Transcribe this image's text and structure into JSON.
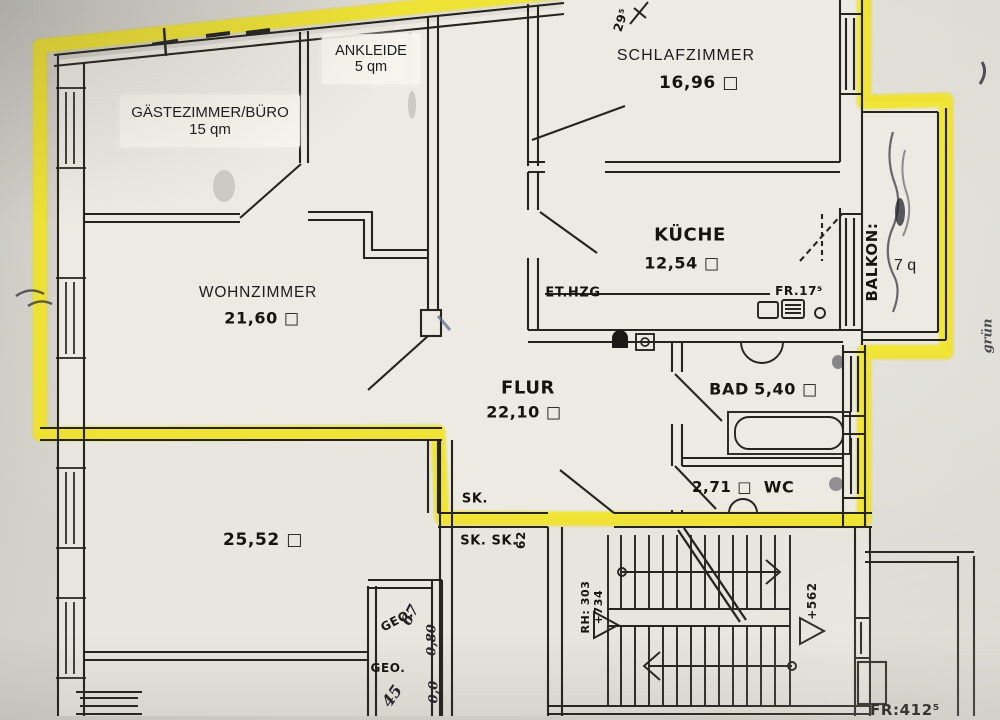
{
  "plan": {
    "highlight_color": "#f2e51a",
    "rooms": {
      "gaestezimmer": {
        "name": "GÄSTEZIMMER/BÜRO",
        "area": "15 qm"
      },
      "ankleide": {
        "name": "ANKLEIDE",
        "area": "5 qm"
      },
      "schlafzimmer": {
        "name": "SCHLAFZIMMER",
        "area": "16,96 □"
      },
      "kueche": {
        "name": "KÜCHE",
        "area": "12,54 □"
      },
      "wohnzimmer": {
        "name": "WOHNZIMMER",
        "area": "21,60 □"
      },
      "flur": {
        "name": "FLUR",
        "area": "22,10 □"
      },
      "bad": {
        "name": "BAD",
        "area": "5,40 □"
      },
      "wc": {
        "name": "WC",
        "area": "2,71 □"
      },
      "balkon": {
        "name": "BALKON:",
        "area": "7 q"
      },
      "untere_zimmer": {
        "area": "25,52 □"
      }
    },
    "annotations": {
      "et_hzg": "ET.HZG",
      "fr_kueche": "FR.17⁵",
      "sk_top": "SK.",
      "sk_double": "SK. SK.",
      "dim_62": "62",
      "dim_295": "29⁵",
      "rh_line1": "RH: 303",
      "rh_line2": "+734",
      "level_562": "+562",
      "geo_1": "GEO.",
      "geo_2": "GEO.",
      "fr_bottom": "FR:412⁵"
    },
    "handwriting": {
      "gruen": "grün",
      "n67": "67",
      "n080": "0,80",
      "n45": "45",
      "n00": "0,0"
    }
  }
}
